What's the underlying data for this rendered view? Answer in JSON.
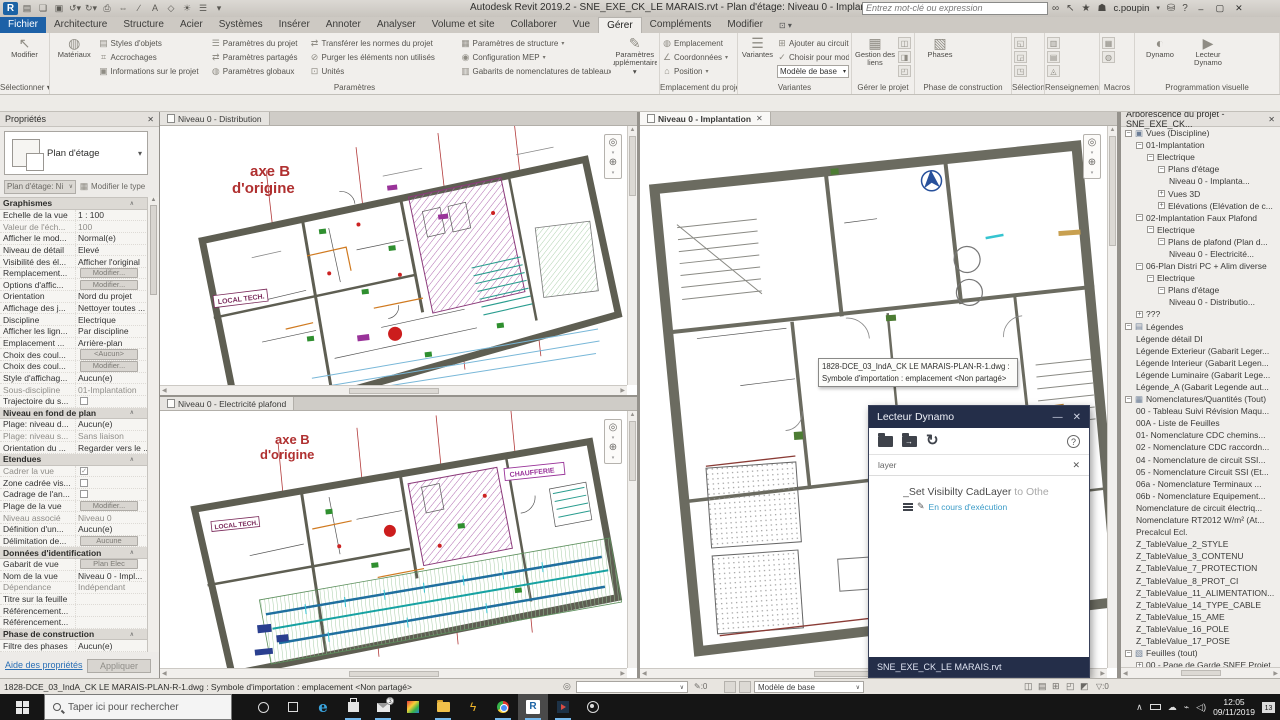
{
  "colors": {
    "accent_blue": "#1d61a7",
    "dynamo_navy": "#242e49",
    "running_blue": "#76b9ed",
    "plan_red": "#b03030",
    "plan_wall": "#5e5e52",
    "status_blue": "#3a9bc7"
  },
  "titlebar": {
    "title": "Autodesk Revit 2019.2 - SNE_EXE_CK_LE MARAIS.rvt - Plan d'étage: Niveau 0 - Implantation",
    "search_placeholder": "Entrez mot-clé ou expression",
    "user": "c.poupin"
  },
  "ribbon": {
    "tabs": [
      {
        "label": "Fichier",
        "style": "file"
      },
      {
        "label": "Architecture"
      },
      {
        "label": "Structure"
      },
      {
        "label": "Acier"
      },
      {
        "label": "Systèmes"
      },
      {
        "label": "Insérer"
      },
      {
        "label": "Annoter"
      },
      {
        "label": "Analyser"
      },
      {
        "label": "Volume et site"
      },
      {
        "label": "Collaborer"
      },
      {
        "label": "Vue"
      },
      {
        "label": "Gérer",
        "active": true
      },
      {
        "label": "Compléments"
      },
      {
        "label": "Modifier"
      }
    ],
    "panels": [
      {
        "label": "Sélectionner",
        "arrow": true,
        "groups": [
          {
            "kind": "big",
            "label": "Modifier",
            "glyph": "cursor"
          }
        ]
      },
      {
        "label": "Paramètres",
        "groups": [
          {
            "kind": "big",
            "label": "Matériaux",
            "glyph": "sphere"
          },
          {
            "kind": "col",
            "w": 114,
            "buttons": [
              {
                "label": "Styles d'objets",
                "glyph": "styles"
              },
              {
                "label": "Accrochages",
                "glyph": "snap"
              },
              {
                "label": "Informations sur le projet",
                "glyph": "info"
              }
            ]
          },
          {
            "kind": "col",
            "w": 100,
            "buttons": [
              {
                "label": "Paramètres du projet",
                "glyph": "param"
              },
              {
                "label": "Paramètres partagés",
                "glyph": "shared"
              },
              {
                "label": "Paramètres  globaux",
                "glyph": "global"
              }
            ]
          },
          {
            "kind": "col",
            "w": 154,
            "buttons": [
              {
                "label": "Transférer les normes du projet",
                "glyph": "transfer"
              },
              {
                "label": "Purger les éléments non utilisés",
                "glyph": "purge"
              },
              {
                "label": "Unités",
                "glyph": "units"
              }
            ]
          },
          {
            "kind": "col",
            "w": 150,
            "buttons": [
              {
                "label": "Paramètres de structure",
                "glyph": "struct",
                "arrow": true
              },
              {
                "label": "Configuration MEP",
                "glyph": "mep",
                "arrow": true
              },
              {
                "label": "Gabarits de nomenclatures de tableaux",
                "glyph": "sched",
                "arrow": true
              }
            ]
          },
          {
            "kind": "big",
            "label": "Paramètres supplémentaires",
            "glyph": "extra",
            "arrow": true
          }
        ]
      },
      {
        "label": "Emplacement du projet",
        "groups": [
          {
            "kind": "col",
            "w": 74,
            "buttons": [
              {
                "label": "Emplacement",
                "glyph": "location"
              },
              {
                "label": "Coordonnées",
                "glyph": "coords",
                "arrow": true
              },
              {
                "label": "Position",
                "glyph": "position",
                "arrow": true
              }
            ]
          }
        ]
      },
      {
        "label": "Variantes",
        "groups": [
          {
            "kind": "big",
            "label": "Variantes",
            "glyph": "variants"
          },
          {
            "kind": "colcombo",
            "w": 72,
            "buttons": [
              {
                "label": "Ajouter au circuit",
                "glyph": "addcircuit"
              },
              {
                "label": "Choisir pour modifier",
                "glyph": "pick"
              }
            ],
            "combo": "Modèle de base"
          }
        ]
      },
      {
        "label": "Gérer le projet",
        "groups": [
          {
            "kind": "big",
            "label": "Gestion des liens",
            "glyph": "links"
          },
          {
            "kind": "igrid",
            "cols": 1,
            "glyphs": [
              "img",
              "decal",
              "start"
            ]
          }
        ]
      },
      {
        "label": "Phase de construction",
        "groups": [
          {
            "kind": "big",
            "label": "Phases",
            "glyph": "phases"
          }
        ]
      },
      {
        "label": "Sélection",
        "groups": [
          {
            "kind": "igrid",
            "cols": 1,
            "glyphs": [
              "savesel",
              "loadsel",
              "editsel"
            ]
          }
        ]
      },
      {
        "label": "Renseignements",
        "groups": [
          {
            "kind": "igrid",
            "cols": 1,
            "glyphs": [
              "ids",
              "selid",
              "warn"
            ]
          }
        ]
      },
      {
        "label": "Macros",
        "groups": [
          {
            "kind": "igrid",
            "cols": 1,
            "glyphs": [
              "macromgr",
              "macrosec"
            ]
          }
        ]
      },
      {
        "label": "Programmation visuelle",
        "groups": [
          {
            "kind": "big",
            "label": "Dynamo",
            "glyph": "dynamo"
          },
          {
            "kind": "big",
            "label": "Lecteur Dynamo",
            "glyph": "player"
          }
        ]
      }
    ]
  },
  "properties": {
    "title": "Propriétés",
    "type_name": "Plan d'étage",
    "selector": "Plan d'étage: Ni",
    "modify_type": "Modifier le type",
    "help": "Aide des propriétés",
    "apply": "Appliquer",
    "rows": [
      {
        "h": "Graphismes"
      },
      {
        "label": "Echelle de la vue",
        "value": "1 : 100"
      },
      {
        "label": "Valeur de l'éch...",
        "value": "100",
        "dim": true
      },
      {
        "label": "Afficher le mod...",
        "value": "Normal(e)"
      },
      {
        "label": "Niveau de détail",
        "value": "Elevé"
      },
      {
        "label": "Visibilité des él...",
        "value": "Afficher l'original"
      },
      {
        "label": "Remplacement...",
        "kind": "btn",
        "value": "Modifier..."
      },
      {
        "label": "Options d'affic...",
        "kind": "btn",
        "value": "Modifier..."
      },
      {
        "label": "Orientation",
        "value": "Nord du projet"
      },
      {
        "label": "Affichage des j...",
        "value": "Nettoyer toutes ..."
      },
      {
        "label": "Discipline",
        "value": "Electrique"
      },
      {
        "label": "Afficher les lign...",
        "value": "Par discipline"
      },
      {
        "label": "Emplacement ...",
        "value": "Arrière-plan"
      },
      {
        "label": "Choix des coul...",
        "kind": "btn",
        "value": "<Aucun>"
      },
      {
        "label": "Choix des coul...",
        "kind": "btn",
        "value": "Modifier..."
      },
      {
        "label": "Style d'affichag...",
        "value": "Aucun(e)"
      },
      {
        "label": "Sous-discipline",
        "value": "01-Implantation",
        "dim": true
      },
      {
        "label": "Trajectoire du s...",
        "kind": "chk"
      },
      {
        "h": "Niveau en fond de plan"
      },
      {
        "label": "Plage: niveau d...",
        "value": "Aucun(e)"
      },
      {
        "label": "Plage: niveau s...",
        "value": "Sans liaison",
        "dim": true
      },
      {
        "label": "Orientation du ...",
        "value": "Regarder vers le ..."
      },
      {
        "h": "Etendues"
      },
      {
        "label": "Cadrer la vue",
        "kind": "chk1",
        "dim": true
      },
      {
        "label": "Zone cadrée vis...",
        "kind": "chk"
      },
      {
        "label": "Cadrage de l'an...",
        "kind": "chk"
      },
      {
        "label": "Plage de la vue",
        "kind": "btn",
        "value": "Modifier..."
      },
      {
        "label": "Niveau associé",
        "value": "Niveau 0",
        "dim": true
      },
      {
        "label": "Définition d'un...",
        "value": "Aucun(e)"
      },
      {
        "label": "Délimitation de...",
        "kind": "btn",
        "value": "Aucune"
      },
      {
        "h": "Données d'identification"
      },
      {
        "label": "Gabarit de vue",
        "kind": "btn",
        "value": "Plan Elec"
      },
      {
        "label": "Nom de la vue",
        "value": "Niveau 0 - Impl..."
      },
      {
        "label": "Dépendance",
        "value": "Indépendant",
        "dim": true
      },
      {
        "label": "Titre sur la feuille",
        "value": ""
      },
      {
        "label": "Référencement...",
        "value": ""
      },
      {
        "label": "Référencement...",
        "value": ""
      },
      {
        "h": "Phase de construction"
      },
      {
        "label": "Filtre des phases",
        "value": "Aucun(e)"
      }
    ]
  },
  "views": {
    "tab_distribution": "Niveau 0 - Distribution",
    "tab_implantation": "Niveau 0 - Implantation",
    "tab_elec_plafond": "Niveau 0 - Electricité plafond"
  },
  "plans": {
    "axis_line1": "axe B",
    "axis_line2": "d'origine",
    "local_tech": "LOCAL TECH.",
    "chaufferie": "CHAUFFERIE"
  },
  "tooltip": {
    "line1": "1828-DCE_03_IndA_CK LE MARAIS-PLAN-R-1.dwg :",
    "line2": "Symbole d'importation : emplacement <Non partagé>"
  },
  "dynamo": {
    "title": "Lecteur Dynamo",
    "filter": "layer",
    "script_name": "_Set Visibilty CadLayer",
    "script_suffix": " to Othe",
    "status": "En cours d'exécution",
    "file": "SNE_EXE_CK_LE MARAIS.rvt"
  },
  "browser": {
    "title": "Arborescence du projet - SNE_EXE_CK...",
    "items": [
      {
        "l": 0,
        "e": "-",
        "icon": "views",
        "t": "Vues (Discipline)"
      },
      {
        "l": 1,
        "e": "-",
        "t": "01-Implantation"
      },
      {
        "l": 2,
        "e": "-",
        "t": "Electrique"
      },
      {
        "l": 3,
        "e": "-",
        "t": "Plans d'étage"
      },
      {
        "l": 4,
        "t": "Niveau 0 - Implanta...",
        "b": true
      },
      {
        "l": 3,
        "e": "+",
        "t": "Vues 3D"
      },
      {
        "l": 3,
        "e": "+",
        "t": "Elévations (Elévation de c..."
      },
      {
        "l": 1,
        "e": "-",
        "t": "02-Implantation Faux Plafond"
      },
      {
        "l": 2,
        "e": "-",
        "t": "Electrique"
      },
      {
        "l": 3,
        "e": "-",
        "t": "Plans de plafond (Plan d..."
      },
      {
        "l": 4,
        "t": "Niveau 0 - Electricité..."
      },
      {
        "l": 1,
        "e": "-",
        "t": "06-Plan Distri PC + Alim diverse"
      },
      {
        "l": 2,
        "e": "-",
        "t": "Electrique"
      },
      {
        "l": 3,
        "e": "-",
        "t": "Plans d'étage"
      },
      {
        "l": 4,
        "t": "Niveau 0 - Distributio..."
      },
      {
        "l": 1,
        "e": "+",
        "t": "???"
      },
      {
        "l": 0,
        "e": "-",
        "icon": "legends",
        "t": "Légendes"
      },
      {
        "l": 1,
        "t": "Légende détail DI"
      },
      {
        "l": 1,
        "t": "Légende Exterieur (Gabarit Leger..."
      },
      {
        "l": 1,
        "t": "Légende Interieur (Gabarit Legen..."
      },
      {
        "l": 1,
        "t": "Légende Luminaire (Gabarit Lege..."
      },
      {
        "l": 1,
        "t": "Légende_A (Gabarit Legende aut..."
      },
      {
        "l": 0,
        "e": "-",
        "icon": "schedules",
        "t": "Nomenclatures/Quantités (Tout)"
      },
      {
        "l": 1,
        "t": "00 - Tableau Suivi Révision Maqu..."
      },
      {
        "l": 1,
        "t": "00A - Liste de Feuilles"
      },
      {
        "l": 1,
        "t": "01- Nomenclature CDC chemins..."
      },
      {
        "l": 1,
        "t": "02 - Nomenclature CDC raccordn..."
      },
      {
        "l": 1,
        "t": "04 - Nomenclature de circuit SSI..."
      },
      {
        "l": 1,
        "t": "05 - Nomenclature Circuit SSI (Et..."
      },
      {
        "l": 1,
        "t": "06a - Nomenclature Terminaux ..."
      },
      {
        "l": 1,
        "t": "06b - Nomenclature Equipement..."
      },
      {
        "l": 1,
        "t": "Nomenclature de circuit électriq..."
      },
      {
        "l": 1,
        "t": "Nomenclature RT2012 W/m² (At..."
      },
      {
        "l": 1,
        "t": "Precalcul Ecl."
      },
      {
        "l": 1,
        "t": "Z_TableValue_2_STYLE"
      },
      {
        "l": 1,
        "t": "Z_TableValue_3_CONTENU"
      },
      {
        "l": 1,
        "t": "Z_TableValue_7_PROTECTION"
      },
      {
        "l": 1,
        "t": "Z_TableValue_8_PROT_CI"
      },
      {
        "l": 1,
        "t": "Z_TableValue_11_ALIMENTATION..."
      },
      {
        "l": 1,
        "t": "Z_TableValue_14_TYPE_CABLE"
      },
      {
        "l": 1,
        "t": "Z_TableValue_15_AME"
      },
      {
        "l": 1,
        "t": "Z_TableValue_16_POLE"
      },
      {
        "l": 1,
        "t": "Z_TableValue_17_POSE"
      },
      {
        "l": 0,
        "e": "-",
        "icon": "sheets",
        "t": "Feuilles (tout)"
      },
      {
        "l": 1,
        "e": "+",
        "t": "00 - Page de Garde SNEE Projet..."
      }
    ]
  },
  "statusbar": {
    "message": "1828-DCE_03_IndA_CK LE MARAIS-PLAN-R-1.dwg : Symbole d'importation : emplacement <Non partagé>",
    "editable_count": ":0",
    "variant": "Modèle de base",
    "filter_count": ":0"
  },
  "taskbar": {
    "search_placeholder": "Taper ici pour rechercher",
    "time": "12:05",
    "date": "09/11/2019",
    "notif_count": "13",
    "icons": [
      {
        "name": "cortana"
      },
      {
        "name": "taskview"
      },
      {
        "name": "edge"
      },
      {
        "name": "store",
        "running": true
      },
      {
        "name": "mail",
        "badge": "3",
        "running": true
      },
      {
        "name": "photos"
      },
      {
        "name": "explorer",
        "running": true
      },
      {
        "name": "snagit"
      },
      {
        "name": "chrome",
        "running": true
      },
      {
        "name": "revit",
        "active": true,
        "running": true
      },
      {
        "name": "media",
        "running": true
      },
      {
        "name": "obs"
      }
    ]
  }
}
